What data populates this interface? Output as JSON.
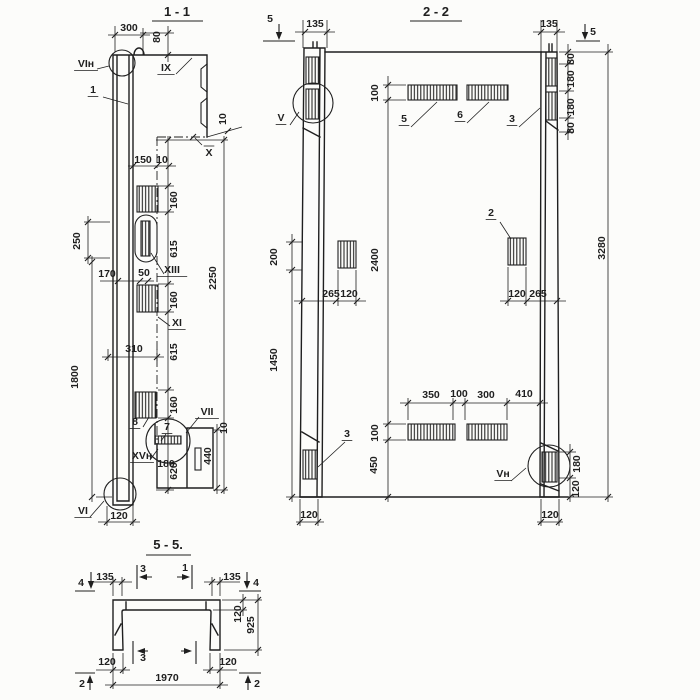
{
  "drawing": {
    "kind": "reinforced-concrete wall panel working drawing, sections",
    "colors": {
      "ink": "#1f1f1f",
      "paper": "#fcfcfa"
    }
  },
  "sections": {
    "s1": {
      "title": "1 - 1",
      "labels": [
        {
          "n": "dim-300",
          "t": "300",
          "x": 129,
          "y": 31
        },
        {
          "n": "dim-80",
          "t": "80",
          "x": 160,
          "y": 37,
          "r": -90
        },
        {
          "n": "view-label-vi-n-top",
          "t": "VIн",
          "x": 86,
          "y": 67,
          "ul": 1
        },
        {
          "n": "item-callout-1",
          "t": "1",
          "x": 93,
          "y": 93,
          "ul": 1
        },
        {
          "n": "view-label-ix",
          "t": "IX",
          "x": 166,
          "y": 71,
          "ul": 1
        },
        {
          "n": "dim-10-offset-top",
          "t": "10",
          "x": 226,
          "y": 119,
          "r": -90
        },
        {
          "n": "view-label-x",
          "t": "X",
          "x": 209,
          "y": 156,
          "ol": 1
        },
        {
          "n": "dim-150",
          "t": "150",
          "x": 143,
          "y": 163
        },
        {
          "n": "dim-10-web",
          "t": "10",
          "x": 162,
          "y": 163
        },
        {
          "n": "dim-160-a",
          "t": "160",
          "x": 177,
          "y": 200,
          "r": -90
        },
        {
          "n": "dim-615-a",
          "t": "615",
          "x": 177,
          "y": 249,
          "r": -90
        },
        {
          "n": "dim-2250",
          "t": "2250",
          "x": 216,
          "y": 278,
          "r": -90
        },
        {
          "n": "dim-250",
          "t": "250",
          "x": 80,
          "y": 241,
          "r": -90
        },
        {
          "n": "dim-170",
          "t": "170",
          "x": 107,
          "y": 277
        },
        {
          "n": "dim-50",
          "t": "50",
          "x": 144,
          "y": 276
        },
        {
          "n": "view-label-xiii",
          "t": "XIII",
          "x": 172,
          "y": 273,
          "ul": 1
        },
        {
          "n": "dim-160-b",
          "t": "160",
          "x": 177,
          "y": 300,
          "r": -90
        },
        {
          "n": "view-label-xi",
          "t": "XI",
          "x": 177,
          "y": 326,
          "ul": 1
        },
        {
          "n": "dim-310",
          "t": "310",
          "x": 134,
          "y": 352
        },
        {
          "n": "dim-615-b",
          "t": "615",
          "x": 177,
          "y": 352,
          "r": -90
        },
        {
          "n": "dim-1800",
          "t": "1800",
          "x": 78,
          "y": 377,
          "r": -90
        },
        {
          "n": "dim-160-c",
          "t": "160",
          "x": 177,
          "y": 405,
          "r": -90
        },
        {
          "n": "item-callout-8",
          "t": "8",
          "x": 135,
          "y": 425,
          "ul": 1
        },
        {
          "n": "item-callout-7",
          "t": "7",
          "x": 167,
          "y": 430,
          "ul": 1
        },
        {
          "n": "view-label-vii",
          "t": "VII",
          "x": 207,
          "y": 415,
          "ul": 1
        },
        {
          "n": "dim-10-step",
          "t": "10",
          "x": 227,
          "y": 428,
          "r": -90
        },
        {
          "n": "view-label-xv-n",
          "t": "XVн",
          "x": 142,
          "y": 459,
          "ul": 1
        },
        {
          "n": "dim-180",
          "t": "180",
          "x": 166,
          "y": 467
        },
        {
          "n": "dim-440",
          "t": "440",
          "x": 211,
          "y": 456,
          "r": -90
        },
        {
          "n": "dim-620",
          "t": "620",
          "x": 177,
          "y": 471,
          "r": -90
        },
        {
          "n": "view-label-vi-bottom",
          "t": "VI",
          "x": 83,
          "y": 514,
          "ul": 1
        },
        {
          "n": "dim-120-bottom",
          "t": "120",
          "x": 119,
          "y": 519
        }
      ]
    },
    "s2": {
      "title": "2 - 2",
      "labels": [
        {
          "n": "cut-mark-5-left",
          "t": "5",
          "x": 270,
          "y": 22
        },
        {
          "n": "dim-135-left",
          "t": "135",
          "x": 315,
          "y": 27
        },
        {
          "n": "dim-135-right",
          "t": "135",
          "x": 549,
          "y": 27
        },
        {
          "n": "cut-mark-5-right",
          "t": "5",
          "x": 593,
          "y": 35
        },
        {
          "n": "dim-80-a",
          "t": "80",
          "x": 574,
          "y": 59,
          "r": -90
        },
        {
          "n": "dim-180-a",
          "t": "180",
          "x": 574,
          "y": 79,
          "r": -90
        },
        {
          "n": "dim-180-b",
          "t": "180",
          "x": 574,
          "y": 107,
          "r": -90
        },
        {
          "n": "dim-80-b",
          "t": "80",
          "x": 574,
          "y": 128,
          "r": -90
        },
        {
          "n": "view-label-v",
          "t": "V",
          "x": 281,
          "y": 121,
          "ul": 1
        },
        {
          "n": "dim-100-top",
          "t": "100",
          "x": 378,
          "y": 93,
          "r": -90
        },
        {
          "n": "item-callout-5",
          "t": "5",
          "x": 404,
          "y": 122,
          "ul": 1
        },
        {
          "n": "item-callout-6",
          "t": "6",
          "x": 460,
          "y": 118,
          "ul": 1
        },
        {
          "n": "item-callout-3-top",
          "t": "3",
          "x": 512,
          "y": 122,
          "ul": 1
        },
        {
          "n": "dim-200",
          "t": "200",
          "x": 277,
          "y": 257,
          "r": -90
        },
        {
          "n": "dim-2400",
          "t": "2400",
          "x": 378,
          "y": 260,
          "r": -90
        },
        {
          "n": "dim-265-left",
          "t": "265",
          "x": 331,
          "y": 297
        },
        {
          "n": "dim-120-mid-left",
          "t": "120",
          "x": 349,
          "y": 297
        },
        {
          "n": "item-callout-2",
          "t": "2",
          "x": 491,
          "y": 216,
          "ul": 1
        },
        {
          "n": "dim-120-mid-right",
          "t": "120",
          "x": 517,
          "y": 297
        },
        {
          "n": "dim-265-right",
          "t": "265",
          "x": 538,
          "y": 297
        },
        {
          "n": "dim-3280",
          "t": "3280",
          "x": 605,
          "y": 248,
          "r": -90
        },
        {
          "n": "dim-1450",
          "t": "1450",
          "x": 277,
          "y": 360,
          "r": -90
        },
        {
          "n": "dim-350",
          "t": "350",
          "x": 431,
          "y": 398
        },
        {
          "n": "dim-100-mid",
          "t": "100",
          "x": 459,
          "y": 397
        },
        {
          "n": "dim-300",
          "t": "300",
          "x": 486,
          "y": 398
        },
        {
          "n": "dim-410",
          "t": "410",
          "x": 524,
          "y": 397
        },
        {
          "n": "dim-100-bottom",
          "t": "100",
          "x": 378,
          "y": 433,
          "r": -90
        },
        {
          "n": "dim-450",
          "t": "450",
          "x": 377,
          "y": 465,
          "r": -90
        },
        {
          "n": "item-callout-3-bottom",
          "t": "3",
          "x": 347,
          "y": 437,
          "ul": 1
        },
        {
          "n": "view-label-v-n",
          "t": "Vн",
          "x": 503,
          "y": 477,
          "ul": 1
        },
        {
          "n": "dim-180-right",
          "t": "180",
          "x": 580,
          "y": 464,
          "r": -90
        },
        {
          "n": "dim-120-right",
          "t": "120",
          "x": 579,
          "y": 489,
          "r": -90
        },
        {
          "n": "dim-120-bottom-left",
          "t": "120",
          "x": 309,
          "y": 518
        },
        {
          "n": "dim-120-bottom-right",
          "t": "120",
          "x": 550,
          "y": 518
        }
      ]
    },
    "s5": {
      "title": "5 - 5.",
      "labels": [
        {
          "n": "cut-mark-4-left",
          "t": "4",
          "x": 81,
          "y": 586
        },
        {
          "n": "dim-135-left",
          "t": "135",
          "x": 105,
          "y": 580
        },
        {
          "n": "cut-mark-3-top",
          "t": "3",
          "x": 143,
          "y": 572
        },
        {
          "n": "cut-mark-1-top",
          "t": "1",
          "x": 185,
          "y": 571
        },
        {
          "n": "dim-135-right",
          "t": "135",
          "x": 232,
          "y": 580
        },
        {
          "n": "cut-mark-4-right",
          "t": "4",
          "x": 256,
          "y": 586
        },
        {
          "n": "dim-120-thickness",
          "t": "120",
          "x": 241,
          "y": 614,
          "r": -90
        },
        {
          "n": "dim-925",
          "t": "925",
          "x": 254,
          "y": 625,
          "r": -90
        },
        {
          "n": "dim-120-bottom-left",
          "t": "120",
          "x": 107,
          "y": 665
        },
        {
          "n": "cut-mark-3-bottom",
          "t": "3",
          "x": 143,
          "y": 661
        },
        {
          "n": "dim-120-bottom-right",
          "t": "120",
          "x": 228,
          "y": 665
        },
        {
          "n": "dim-1970",
          "t": "1970",
          "x": 167,
          "y": 681
        },
        {
          "n": "cut-mark-2-left",
          "t": "2",
          "x": 82,
          "y": 687
        },
        {
          "n": "cut-mark-2-right",
          "t": "2",
          "x": 257,
          "y": 687
        }
      ]
    }
  }
}
